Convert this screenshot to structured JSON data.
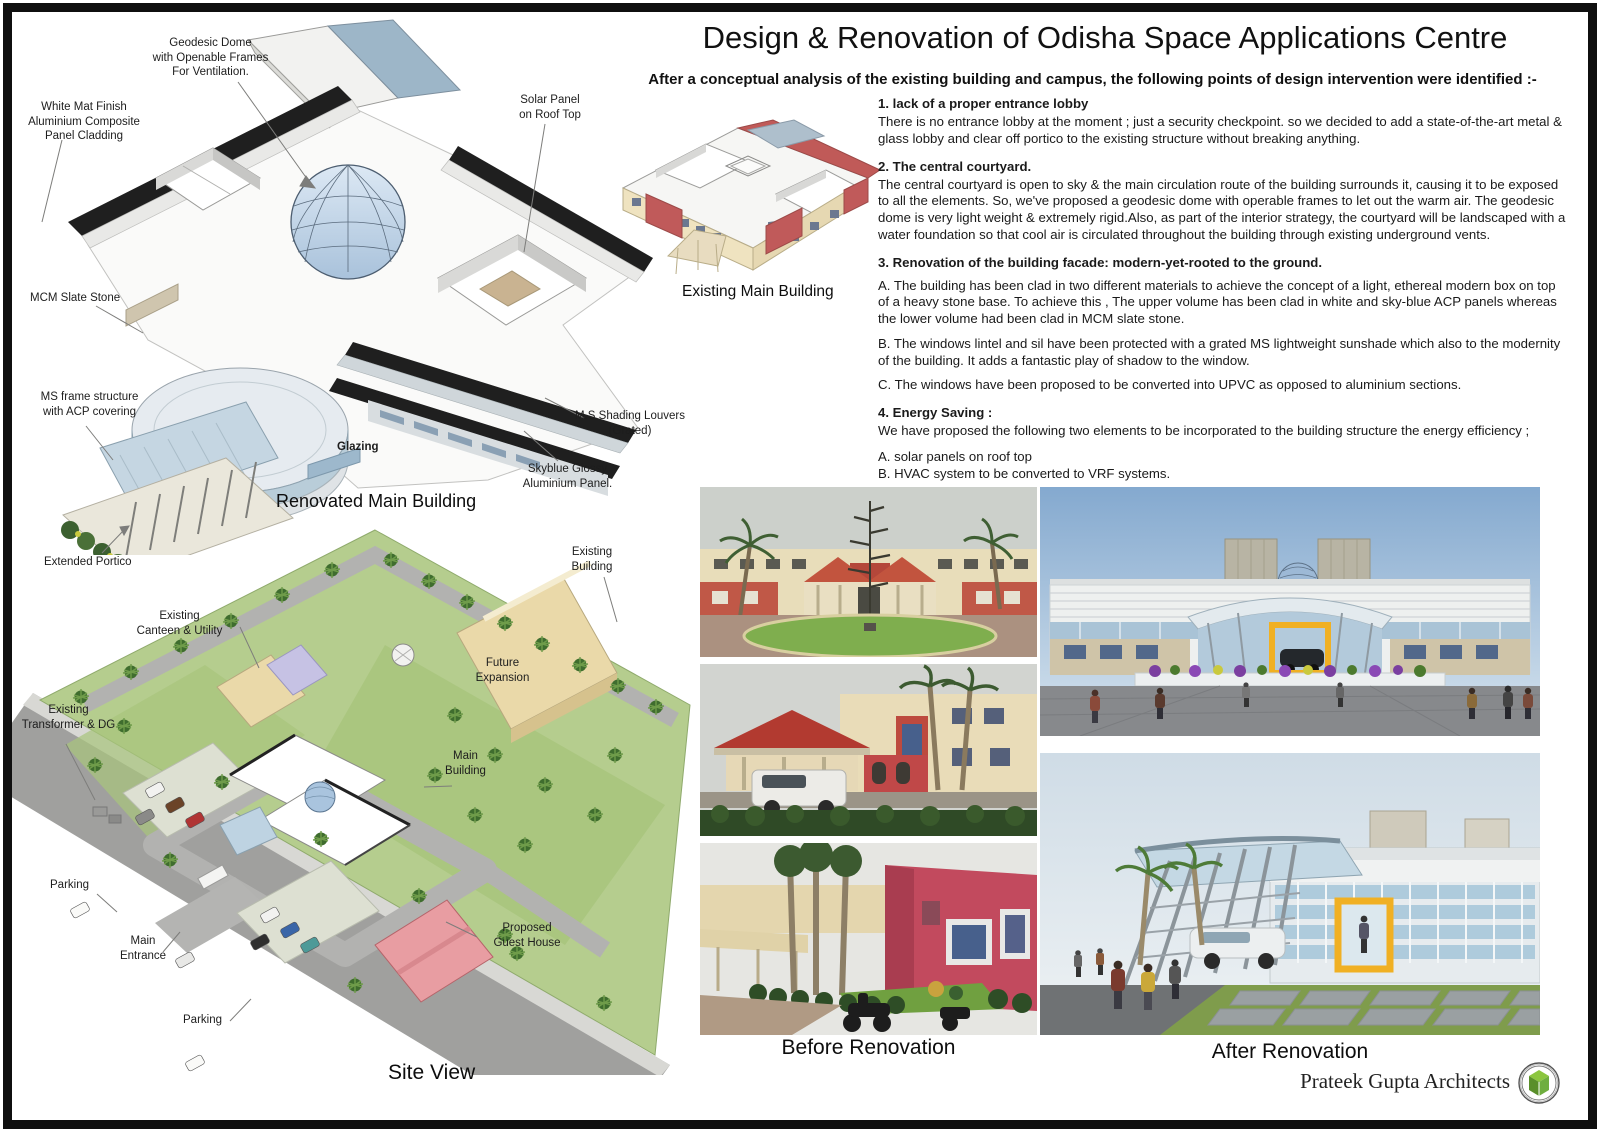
{
  "board": {
    "title": "Design & Renovation of Odisha Space Applications Centre",
    "subtitle": "After a conceptual analysis of the existing building and campus, the following points of design intervention were identified :-",
    "credit": "Prateek Gupta Architects"
  },
  "renovated_axon": {
    "caption": "Renovated Main Building",
    "labels": [
      {
        "name": "geodesic-dome",
        "text": "Geodesic Dome\nwith Openable Frames\nFor Ventilation."
      },
      {
        "name": "acp-cladding",
        "text": "White Mat Finish\nAluminium Composite\nPanel Cladding"
      },
      {
        "name": "solar-panel",
        "text": "Solar Panel\non Roof Top"
      },
      {
        "name": "mcm-slate",
        "text": "MCM Slate Stone"
      },
      {
        "name": "ms-frame",
        "text": "MS frame structure\nwith ACP covering"
      },
      {
        "name": "shading-louvers",
        "text": "M.S Shading Louvers\n(Grated)"
      },
      {
        "name": "skyblue-panel",
        "text": "Skyblue Glossy\nAluminium Panel."
      },
      {
        "name": "glazing",
        "text": "Glazing"
      },
      {
        "name": "extended-portico",
        "text": "Extended Portico"
      }
    ]
  },
  "existing_axon": {
    "caption": "Existing Main Building"
  },
  "site_view": {
    "caption": "Site View",
    "labels": [
      {
        "name": "existing-building",
        "text": "Existing\nBuilding"
      },
      {
        "name": "existing-canteen",
        "text": "Existing\nCanteen & Utility"
      },
      {
        "name": "future-expansion",
        "text": "Future\nExpansion"
      },
      {
        "name": "existing-transformer",
        "text": "Existing\nTransformer & DG"
      },
      {
        "name": "main-building",
        "text": "Main\nBuilding"
      },
      {
        "name": "parking-west",
        "text": "Parking"
      },
      {
        "name": "main-entrance",
        "text": "Main\nEntrance"
      },
      {
        "name": "parking-south",
        "text": "Parking"
      },
      {
        "name": "guest-house",
        "text": "Proposed\nGuest House"
      }
    ]
  },
  "notes": {
    "sections": [
      {
        "heading": "1. lack of a proper entrance lobby",
        "paragraphs": [
          "There is no entrance lobby at the moment ; just a security checkpoint. so we decided to add a state-of-the-art metal & glass lobby and clear off portico to the existing structure without breaking anything."
        ]
      },
      {
        "heading": "2. The central courtyard.",
        "paragraphs": [
          "The central courtyard is open to sky & the main circulation route of the building surrounds it, causing it to be exposed to all the elements. So, we've proposed a geodesic dome with operable frames to let out the warm air. The geodesic dome is very light weight & extremely rigid.Also, as part of the interior strategy, the courtyard will be landscaped with a water foundation so that cool air is circulated throughout the building through existing underground vents."
        ]
      },
      {
        "heading": "3. Renovation of the building facade:  modern-yet-rooted to the ground.",
        "paragraphs": [
          "A. The building has been clad in two different materials to achieve the concept of a light, ethereal modern box on top of a heavy stone base. To achieve this , The upper volume has been clad in white and sky-blue ACP  panels whereas the lower volume had been clad in MCM slate stone.",
          "B. The windows lintel and sil have been protected with a grated MS lightweight sunshade which also to the modernity of the building. It adds a fantastic play of shadow to the window.",
          "C. The windows have been proposed to be converted into UPVC as opposed to aluminium sections."
        ]
      },
      {
        "heading": "4. Energy Saving :",
        "paragraphs": [
          "We have proposed the following two elements to be incorporated to the building structure the energy efficiency ;",
          "A.  solar panels on roof top",
          "B.  HVAC system to be converted to VRF systems."
        ]
      }
    ]
  },
  "gallery": {
    "before_caption": "Before Renovation",
    "after_caption": "After Renovation"
  },
  "colors": {
    "solar_strip": "#1f1f1f",
    "dome_glass": "#aac4dd",
    "portico_canopy": "#c5d6e2",
    "site_lawn": "#b5cd8e",
    "road_grey": "#a0a09e",
    "existing_cream": "#ead9a9",
    "guest_house_pink": "#e89da2",
    "canteen_lavender": "#c6c2e4",
    "before_red": "#c0564a",
    "entrance_yellow": "#f0b023",
    "render_sky": "#84a9cf",
    "flower_purple": "#7b3fa0",
    "logo_green": "#6fae3f"
  }
}
